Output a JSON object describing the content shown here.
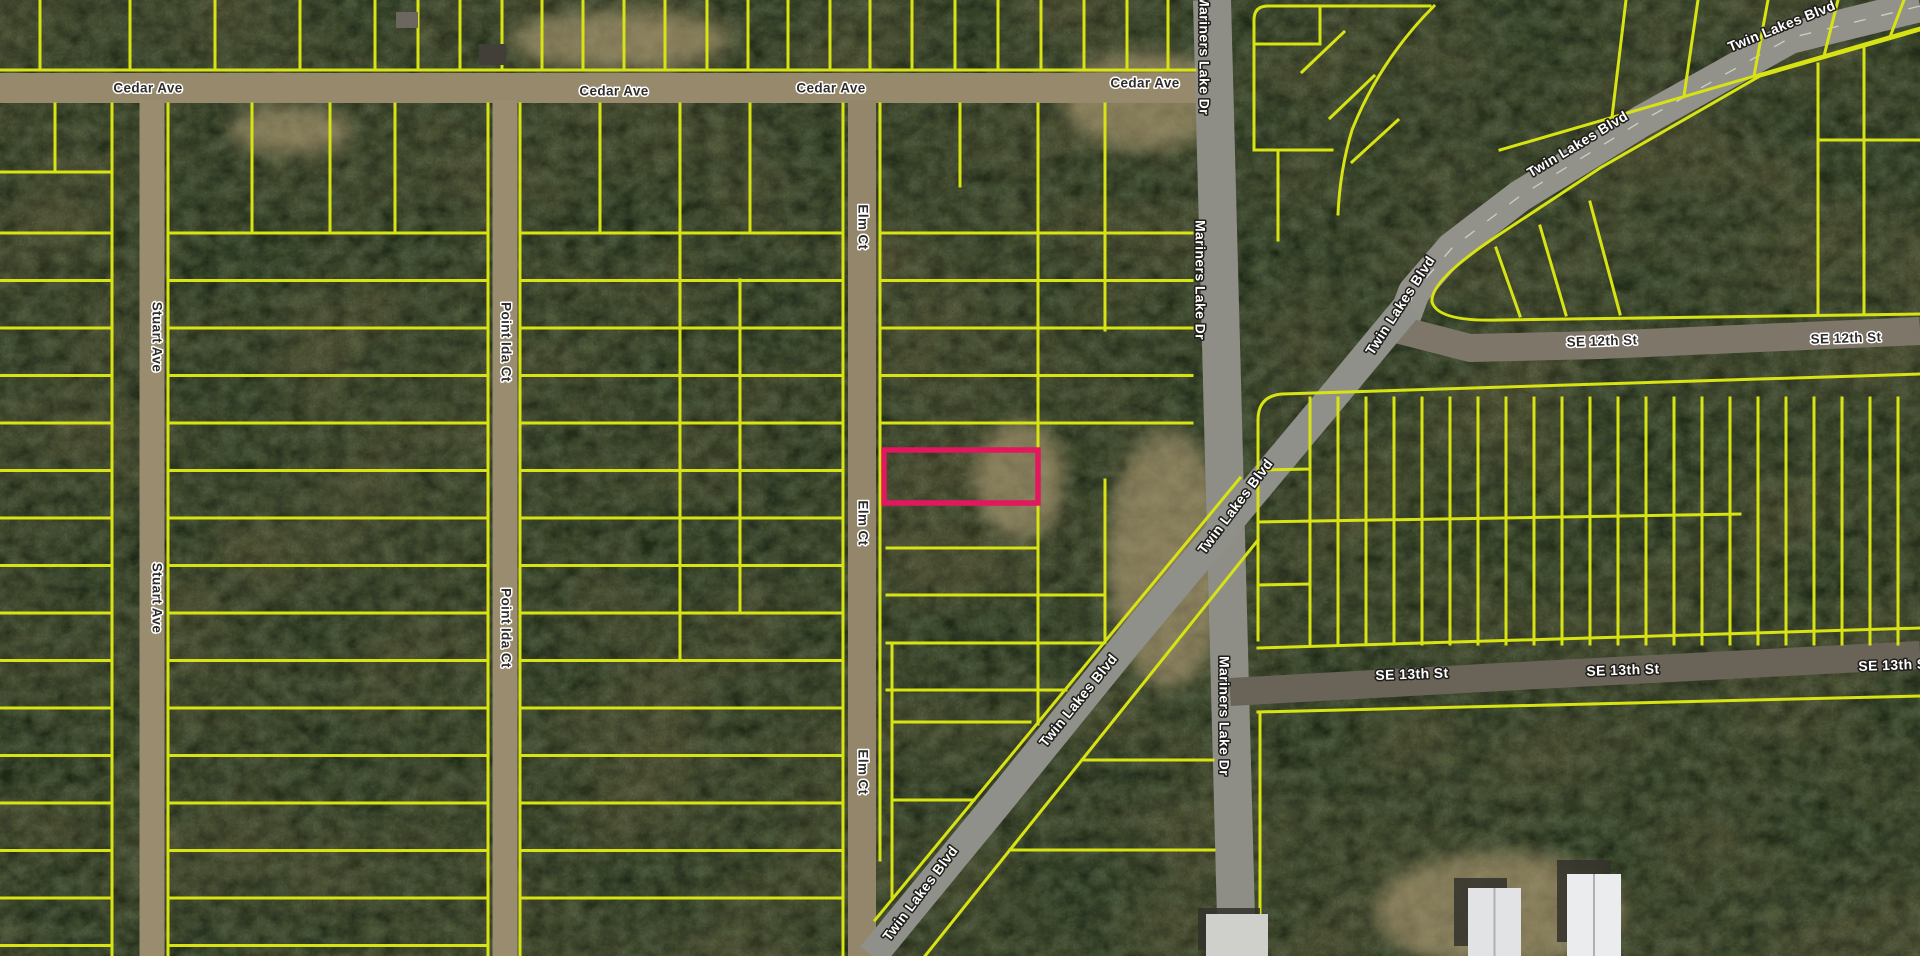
{
  "map": {
    "type": "aerial-parcel-map",
    "background": {
      "base": "#5d6b4b",
      "moss_dark": "#1f2a18",
      "soil_brown": "#8c7452",
      "speckle": "#16200f",
      "clearing_sand": "#bfa87f"
    },
    "colors": {
      "parcel_line": "#d7e312",
      "highlight": "#e3175e",
      "road_centerline": "#ffffff"
    },
    "highlight_parcel": {
      "x": 884,
      "y": 450,
      "width": 154,
      "height": 53
    },
    "roads": [
      {
        "id": "cedar-ave",
        "name": "Cedar Ave",
        "width": 30,
        "color": "#97896c",
        "points": [
          [
            0,
            88
          ],
          [
            1200,
            88
          ]
        ]
      },
      {
        "id": "stuart-ave",
        "name": "Stuart Ave",
        "width": 25,
        "color": "#9a8c6f",
        "points": [
          [
            152,
            100
          ],
          [
            152,
            956
          ]
        ]
      },
      {
        "id": "point-ida-ct",
        "name": "Point Ida Ct",
        "width": 25,
        "color": "#9a8c6f",
        "points": [
          [
            505,
            100
          ],
          [
            505,
            956
          ]
        ]
      },
      {
        "id": "elm-ct",
        "name": "Elm Ct",
        "width": 28,
        "color": "#93866b",
        "points": [
          [
            862,
            100
          ],
          [
            862,
            956
          ]
        ]
      },
      {
        "id": "mariners-lake-dr",
        "name": "Mariners Lake Dr",
        "width": 38,
        "color": "#8e8e87",
        "points": [
          [
            1212,
            0
          ],
          [
            1237,
            956
          ]
        ]
      },
      {
        "id": "twin-lakes-blvd-ne",
        "name": "Twin Lakes Blvd",
        "width": 32,
        "color": "#92928b",
        "centerline": true,
        "points": [
          [
            1920,
            6
          ],
          [
            1790,
            38
          ],
          [
            1640,
            122
          ],
          [
            1520,
            196
          ],
          [
            1452,
            248
          ],
          [
            1414,
            292
          ],
          [
            1400,
            330
          ]
        ]
      },
      {
        "id": "se-12th-st",
        "name": "SE 12th St",
        "width": 28,
        "color": "#7e7769",
        "points": [
          [
            1400,
            330
          ],
          [
            1470,
            348
          ],
          [
            1600,
            345
          ],
          [
            1920,
            331
          ]
        ]
      },
      {
        "id": "twin-lakes-blvd-sw",
        "name": "Twin Lakes Blvd",
        "width": 30,
        "color": "#90908a",
        "points": [
          [
            1408,
            306
          ],
          [
            1330,
            400
          ],
          [
            1240,
            508
          ],
          [
            1128,
            642
          ],
          [
            1000,
            800
          ],
          [
            872,
            956
          ]
        ]
      },
      {
        "id": "se-13th-st",
        "name": "SE 13th St",
        "width": 28,
        "color": "#6a6358",
        "points": [
          [
            1230,
            692
          ],
          [
            1500,
            677
          ],
          [
            1920,
            655
          ]
        ]
      }
    ],
    "labels": [
      {
        "text": "Cedar Ave",
        "x": 148,
        "y": 89,
        "rot": 0,
        "cls": "minor"
      },
      {
        "text": "Cedar Ave",
        "x": 614,
        "y": 92,
        "rot": 0,
        "cls": "minor"
      },
      {
        "text": "Cedar Ave",
        "x": 831,
        "y": 89,
        "rot": 0,
        "cls": "minor"
      },
      {
        "text": "Cedar Ave",
        "x": 1145,
        "y": 84,
        "rot": 0,
        "cls": "minor"
      },
      {
        "text": "Stuart Ave",
        "x": 156,
        "y": 337,
        "rot": 90,
        "cls": "minor"
      },
      {
        "text": "Stuart Ave",
        "x": 156,
        "y": 598,
        "rot": 90,
        "cls": "minor"
      },
      {
        "text": "Point Ida Ct",
        "x": 505,
        "y": 342,
        "rot": 90,
        "cls": "minor"
      },
      {
        "text": "Point Ida Ct",
        "x": 505,
        "y": 628,
        "rot": 90,
        "cls": "minor"
      },
      {
        "text": "Elm Ct",
        "x": 862,
        "y": 227,
        "rot": 90,
        "cls": "minor"
      },
      {
        "text": "Elm Ct",
        "x": 862,
        "y": 523,
        "rot": 90,
        "cls": "minor"
      },
      {
        "text": "Elm Ct",
        "x": 862,
        "y": 772,
        "rot": 90,
        "cls": "minor"
      },
      {
        "text": "Mariners Lake Dr",
        "x": 1203,
        "y": 55,
        "rot": 90,
        "cls": "major"
      },
      {
        "text": "Mariners Lake Dr",
        "x": 1199,
        "y": 280,
        "rot": 90,
        "cls": "major"
      },
      {
        "text": "Mariners Lake Dr",
        "x": 1223,
        "y": 716,
        "rot": 90,
        "cls": "major"
      },
      {
        "text": "Twin Lakes Blvd",
        "x": 1782,
        "y": 27,
        "rot": -22,
        "cls": "major"
      },
      {
        "text": "Twin Lakes Blvd",
        "x": 1578,
        "y": 145,
        "rot": -31,
        "cls": "major"
      },
      {
        "text": "Twin Lakes Blvd",
        "x": 1401,
        "y": 306,
        "rot": -57,
        "cls": "major"
      },
      {
        "text": "Twin Lakes Blvd",
        "x": 1236,
        "y": 507,
        "rot": -53,
        "cls": "major"
      },
      {
        "text": "Twin Lakes Blvd",
        "x": 1079,
        "y": 701,
        "rot": -51,
        "cls": "major"
      },
      {
        "text": "Twin Lakes Blvd",
        "x": 921,
        "y": 894,
        "rot": -53,
        "cls": "major"
      },
      {
        "text": "SE 12th St",
        "x": 1602,
        "y": 342,
        "rot": -2,
        "cls": "minor"
      },
      {
        "text": "SE 12th St",
        "x": 1846,
        "y": 339,
        "rot": -2,
        "cls": "minor"
      },
      {
        "text": "SE 13th St",
        "x": 1412,
        "y": 675,
        "rot": -2,
        "cls": "major"
      },
      {
        "text": "SE 13th St",
        "x": 1623,
        "y": 671,
        "rot": -2,
        "cls": "major"
      },
      {
        "text": "SE 13th St",
        "x": 1895,
        "y": 666,
        "rot": -2,
        "cls": "major"
      }
    ],
    "parcels": {
      "grids": [
        {
          "dir": "v",
          "positions": [
            40,
            130,
            215,
            300,
            375,
            418,
            460,
            502,
            542,
            583,
            624,
            665,
            707,
            748,
            788,
            830,
            870,
            912,
            955,
            998,
            1041,
            1084,
            1127,
            1168
          ],
          "from": 0,
          "to": 70
        },
        {
          "dir": "h",
          "start": 233,
          "pitch": 47.5,
          "count": 16,
          "from": 0,
          "to": 112
        },
        {
          "dir": "h",
          "start": 233,
          "pitch": 47.5,
          "count": 16,
          "from": 168,
          "to": 488
        },
        {
          "dir": "h",
          "start": 233,
          "pitch": 47.5,
          "count": 15,
          "from": 520,
          "to": 843
        },
        {
          "dir": "h",
          "start": 233,
          "pitch": 47.5,
          "count": 5,
          "from": 880,
          "to": 1192
        },
        {
          "dir": "v",
          "start": 1310,
          "pitch": 28,
          "count": 22,
          "from": 398,
          "to": 644
        }
      ],
      "segments": [
        [
          0,
          70,
          1195,
          70
        ],
        [
          112,
          104,
          112,
          956
        ],
        [
          55,
          104,
          55,
          172
        ],
        [
          0,
          172,
          112,
          172
        ],
        [
          168,
          104,
          168,
          956
        ],
        [
          488,
          104,
          488,
          956
        ],
        [
          252,
          104,
          252,
          233
        ],
        [
          330,
          104,
          330,
          233
        ],
        [
          395,
          104,
          395,
          233
        ],
        [
          520,
          104,
          520,
          956
        ],
        [
          843,
          104,
          843,
          956
        ],
        [
          600,
          104,
          600,
          233
        ],
        [
          680,
          104,
          680,
          233
        ],
        [
          750,
          104,
          750,
          233
        ],
        [
          680,
          233,
          680,
          660
        ],
        [
          740,
          280,
          740,
          612
        ],
        [
          880,
          104,
          880,
          860
        ],
        [
          1038,
          104,
          1038,
          724
        ],
        [
          960,
          104,
          960,
          186
        ],
        [
          1105,
          104,
          1105,
          330
        ],
        [
          1105,
          480,
          1105,
          642
        ],
        [
          887,
          548,
          1038,
          548
        ],
        [
          887,
          595,
          1105,
          595
        ],
        [
          887,
          643,
          1104,
          643
        ],
        [
          887,
          690,
          1066,
          690
        ],
        [
          892,
          722,
          1030,
          722
        ],
        [
          892,
          800,
          974,
          800
        ],
        [
          892,
          643,
          892,
          899
        ],
        [
          1240,
          478,
          875,
          920
        ],
        [
          1258,
          540,
          925,
          956
        ],
        [
          1082,
          760,
          1213,
          760
        ],
        [
          1010,
          850,
          1214,
          850
        ],
        [
          1254,
          44,
          1320,
          44
        ],
        [
          1320,
          6,
          1320,
          44
        ],
        [
          1254,
          150,
          1332,
          150
        ],
        [
          1278,
          150,
          1278,
          240
        ],
        [
          1330,
          118,
          1374,
          76
        ],
        [
          1352,
          162,
          1398,
          120
        ],
        [
          1302,
          72,
          1344,
          32
        ],
        [
          1500,
          150,
          1920,
          28
        ],
        [
          1626,
          0,
          1612,
          117
        ],
        [
          1698,
          0,
          1684,
          96
        ],
        [
          1768,
          0,
          1754,
          76
        ],
        [
          1838,
          0,
          1824,
          56
        ],
        [
          1904,
          0,
          1890,
          37
        ],
        [
          1496,
          248,
          1520,
          316
        ],
        [
          1540,
          226,
          1566,
          315
        ],
        [
          1590,
          202,
          1620,
          314
        ],
        [
          1818,
          64,
          1818,
          314
        ],
        [
          1864,
          47,
          1864,
          314
        ],
        [
          1818,
          140,
          1920,
          140
        ],
        [
          1258,
          470,
          1310,
          469
        ],
        [
          1258,
          585,
          1310,
          584
        ],
        [
          1258,
          522,
          1740,
          514
        ],
        [
          1258,
          648,
          1920,
          628
        ],
        [
          1258,
          712,
          1920,
          696
        ],
        [
          1260,
          712,
          1260,
          956
        ]
      ],
      "paths": [
        "M 1254,150 L 1254,20 Q 1254,6 1268,6 L 1430,6",
        "M 1920,30 L 1760,76 L 1600,168 L 1500,234 Q 1430,280 1432,302 Q 1438,322 1500,320 L 1920,314",
        "M 1258,640 L 1258,420 Q 1258,396 1282,394 L 1920,374",
        "M 1434,6 Q 1380,60 1352,130 Q 1340,170 1338,214"
      ]
    },
    "clearings": [
      {
        "cx": 1145,
        "cy": 100,
        "rx": 80,
        "ry": 50
      },
      {
        "cx": 1168,
        "cy": 560,
        "rx": 60,
        "ry": 130
      },
      {
        "cx": 1500,
        "cy": 910,
        "rx": 125,
        "ry": 58
      },
      {
        "cx": 620,
        "cy": 40,
        "rx": 110,
        "ry": 30
      },
      {
        "cx": 1020,
        "cy": 480,
        "rx": 45,
        "ry": 60
      },
      {
        "cx": 290,
        "cy": 130,
        "rx": 60,
        "ry": 25
      }
    ],
    "buildings": [
      {
        "id": "trailer-north",
        "x": 396,
        "y": 12,
        "w": 22,
        "h": 16,
        "fill": "#6b675f"
      },
      {
        "id": "trailer-cedar",
        "x": 479,
        "y": 44,
        "w": 27,
        "h": 21,
        "fill": "#423f39"
      },
      {
        "id": "house-mariners",
        "x": 1206,
        "y": 914,
        "w": 62,
        "h": 42,
        "fill": "#cfd0cc",
        "shadow": [
          -8,
          -6
        ]
      },
      {
        "id": "warehouse-west",
        "x": 1468,
        "y": 888,
        "w": 53,
        "h": 68,
        "fill": "#e2e3e5",
        "shadow": [
          -14,
          -10
        ],
        "ridge": true
      },
      {
        "id": "warehouse-east",
        "x": 1567,
        "y": 874,
        "w": 54,
        "h": 82,
        "fill": "#ebecee",
        "shadow": [
          -10,
          -14
        ],
        "ridge": true
      }
    ]
  }
}
